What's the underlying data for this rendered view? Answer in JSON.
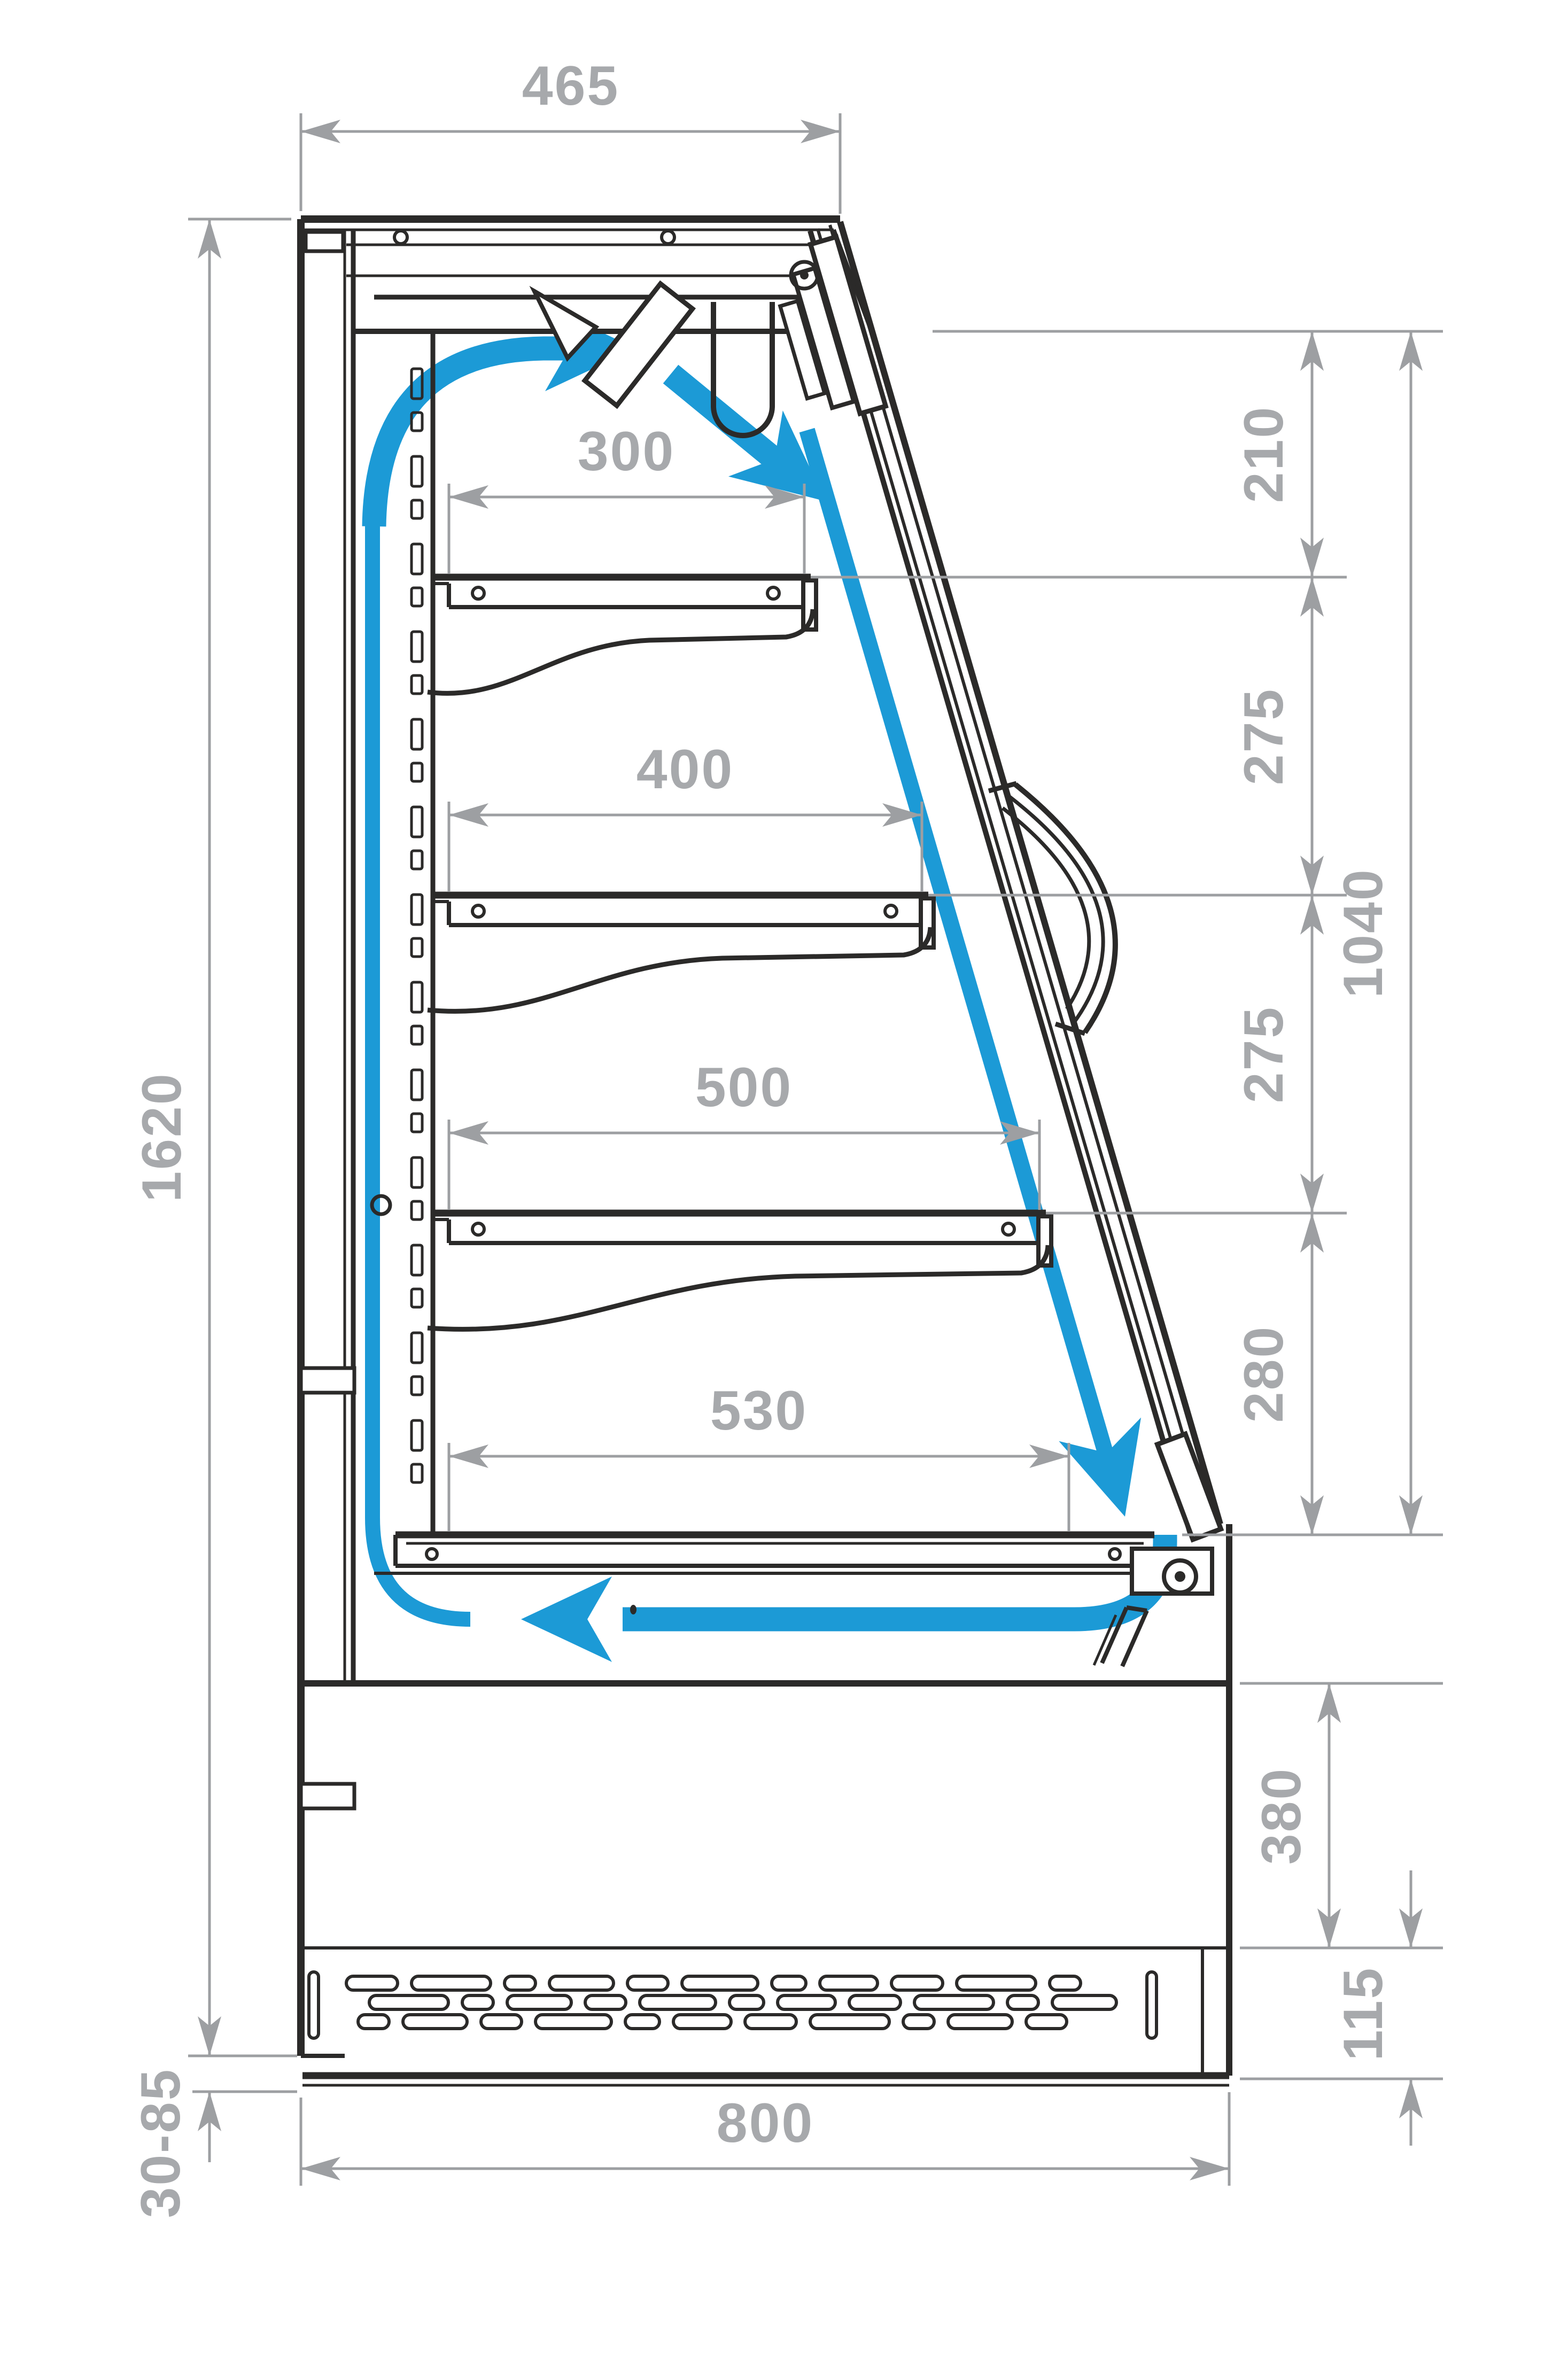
{
  "colors": {
    "outline": "#2b2a29",
    "airflow_blue": "#1c9ad6",
    "dimension_line": "#9d9fa2",
    "dimension_text": "#a7a9ac",
    "background": "#ffffff"
  },
  "dimensions": {
    "top_width": "465",
    "overall_height": "1620",
    "upper_gap": "210",
    "shelf_gap_1": "275",
    "shelf_gap_2": "275",
    "lower_gap": "280",
    "front_opening_height": "1040",
    "shelf_depth_1": "300",
    "shelf_depth_2": "400",
    "shelf_depth_3": "500",
    "bottom_deck_depth": "530",
    "base_front_height": "380",
    "vent_grille_height": "115",
    "adjustable_feet_range": "30-85",
    "total_depth": "800"
  },
  "icons": {
    "airflow_supply_top": "curved-arrow-right",
    "airflow_into_case": "diagonal-arrow-down-right",
    "airflow_air_curtain": "arrow-along-glass-down",
    "airflow_return_bottom": "arrow-left",
    "airflow_back_duct": "vertical-air-band"
  }
}
